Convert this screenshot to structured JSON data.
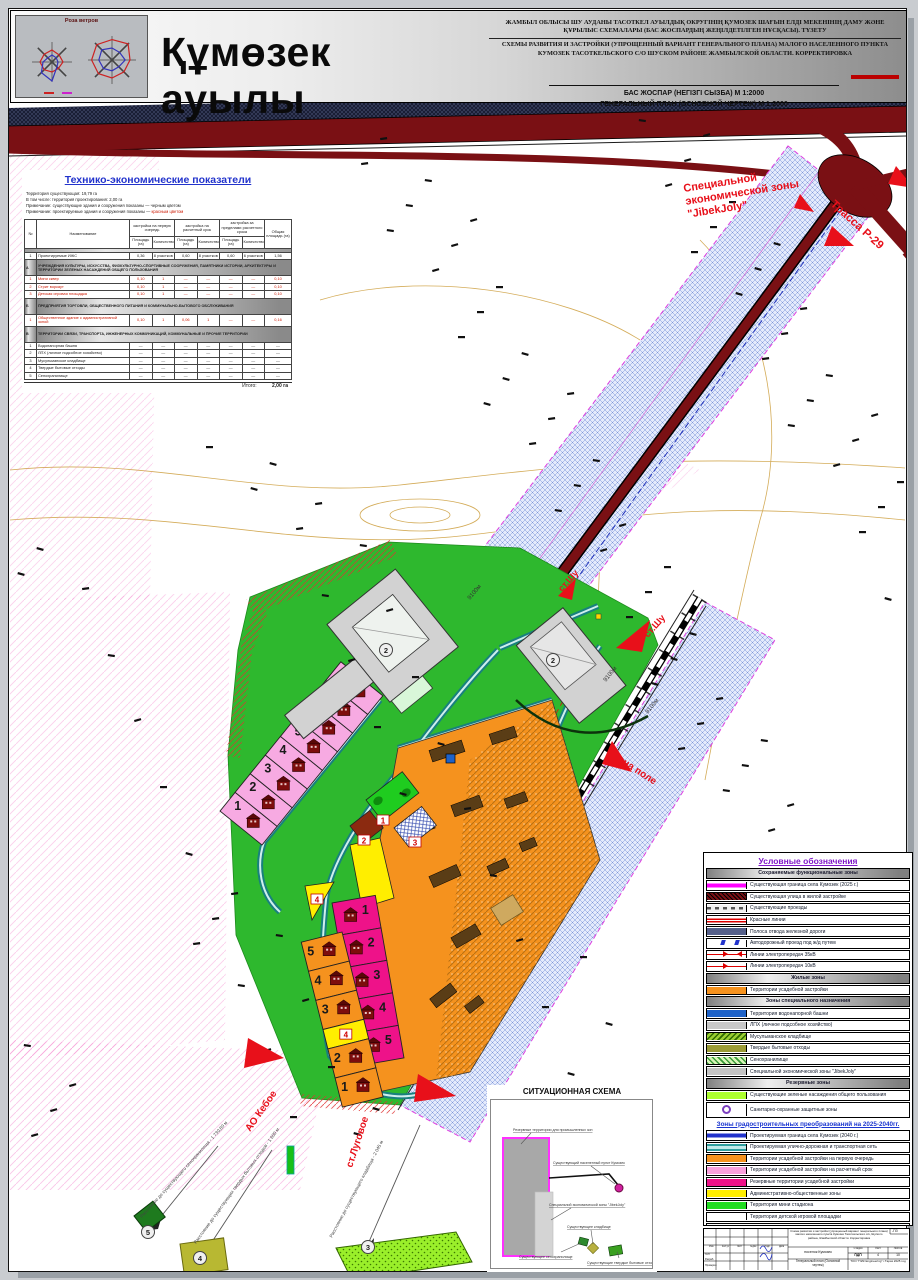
{
  "header": {
    "title": "Құмөзек ауылы",
    "windrose_title": "Роза ветров",
    "subtitle_kk": "ЖАМБЫЛ ОБЛЫСЫ ШУ АУДАНЫ ТАСОТКЕЛ АУЫЛДЫҚ ОКРУГІНІҢ ҚУМОЗЕК ШАҒЫН ЕЛДІ МЕКЕНІНІҢ ДАМУ ЖӘНЕ ҚҰРЫЛЫС СХЕМАЛАРЫ (БАС ЖОСПАРДЫҢ ЖЕҢІЛДЕТІЛГЕН НҰСҚАСЫ). ТҮЗЕТУ",
    "subtitle_ru": "СХЕМЫ РАЗВИТИЯ И ЗАСТРОЙКИ (УПРОЩЕННЫЙ ВАРИАНТ ГЕНЕРАЛЬНОГО ПЛАНА) МАЛОГО НАСЕЛЕННОГО ПУНКТА КУМОЗЕК ТАСОТКЕЛЬСКОГО С/О ШУСКОМ РАЙОНЕ ЖАМБЫЛСКОЙ ОБЛАСТИ. КОРРЕКТИРОВКА",
    "scale_kk": "БАС ЖОСПАР (НЕГІЗГІ СЫЗБА) М 1:2000",
    "scale_ru": "ГЕНЕРАЛЬНЫЙ ПЛАН (ОСНОВНОЙ ЧЕРТЕЖ) М 1:2000"
  },
  "tep": {
    "title": "Технико-экономические показатели",
    "notes": [
      {
        "t": "Территория существующая: 19,79 га"
      },
      {
        "t": "В том числе: территория проектирования: 2,00 га"
      },
      {
        "t": "Примечание: существующие здания и сооружения показаны — черным цветом"
      },
      {
        "t": "Примечание: проектируемые здания и сооружения показаны — ",
        "red": "красным цветом"
      }
    ],
    "col_num": "№",
    "col_name": "Наименование",
    "groups": [
      "застройка на первую очередь",
      "застройка на расчетный срок",
      "застройка за пределами расчетного срока"
    ],
    "subcols": [
      "Площадь (га)",
      "Количество"
    ],
    "col_total": "Общая площадь (га)",
    "rows": [
      {
        "kind": "data",
        "num": "1",
        "name": "Проектируемые ИЖС",
        "c": [
          "0,36",
          "8 участков",
          "0,60",
          "8 участков",
          "0,60",
          "6 участков"
        ],
        "total": "1,56",
        "red": false
      },
      {
        "kind": "section",
        "num": "А",
        "name": "УЧРЕЖДЕНИЯ КУЛЬТУРЫ, ИСКУССТВА, ФИЗКУЛЬТУРНО-СПОРТИВНЫЕ СООРУЖЕНИЯ, ПАМЯТНИКИ ИСТОРИИ, АРХИТЕКТУРЫ И ТЕРРИТОРИИ ЗЕЛЕНЫХ НАСАЖДЕНИЙ ОБЩЕГО ПОЛЬЗОВАНИЯ"
      },
      {
        "kind": "data",
        "num": "1",
        "name": "Мини сквер",
        "c": [
          "0,10",
          "1",
          "—",
          "—",
          "—",
          "—"
        ],
        "total": "0,10",
        "red": true
      },
      {
        "kind": "data",
        "num": "2",
        "name": "Стрит воркаут",
        "c": [
          "0,10",
          "1",
          "—",
          "—",
          "—",
          "—"
        ],
        "total": "0,10",
        "red": true
      },
      {
        "kind": "data",
        "num": "3",
        "name": "Детская игровая площадка",
        "c": [
          "0,10",
          "1",
          "—",
          "—",
          "—",
          "—"
        ],
        "total": "0,10",
        "red": true
      },
      {
        "kind": "section",
        "num": "Б",
        "name": "ПРЕДПРИЯТИЯ ТОРГОВЛИ, ОБЩЕСТВЕННОГО ПИТАНИЯ И КОММУНАЛЬНО-БЫТОВОГО ОБСЛУЖИВАНИЯ"
      },
      {
        "kind": "data",
        "num": "1",
        "name": "Общественное здание с административной зоной",
        "c": [
          "0,10",
          "1",
          "0,06",
          "1",
          "—",
          "—"
        ],
        "total": "0,16",
        "red": true
      },
      {
        "kind": "section",
        "num": "В",
        "name": "ТЕРРИТОРИИ СВЯЗИ, ТРАНСПОРТА, ИНЖЕНЕРНЫХ КОММУНИКАЦИЙ, КОММУНАЛЬНЫЕ И ПРОЧИЕ ТЕРРИТОРИИ"
      },
      {
        "kind": "data",
        "num": "1",
        "name": "Водонапорная башня",
        "c": [
          "—",
          "—",
          "—",
          "—",
          "—",
          "—"
        ],
        "total": "—",
        "red": false
      },
      {
        "kind": "data",
        "num": "2",
        "name": "ЛПХ (личное подсобное хозяйство)",
        "c": [
          "—",
          "—",
          "—",
          "—",
          "—",
          "—"
        ],
        "total": "—",
        "red": false
      },
      {
        "kind": "data",
        "num": "3",
        "name": "Мусульманское кладбище",
        "c": [
          "—",
          "—",
          "—",
          "—",
          "—",
          "—"
        ],
        "total": "—",
        "red": false
      },
      {
        "kind": "data",
        "num": "4",
        "name": "Твердые бытовые отходы",
        "c": [
          "—",
          "—",
          "—",
          "—",
          "—",
          "—"
        ],
        "total": "—",
        "red": false
      },
      {
        "kind": "data",
        "num": "5",
        "name": "Сенохранилище",
        "c": [
          "—",
          "—",
          "—",
          "—",
          "—",
          "—"
        ],
        "total": "—",
        "red": false
      }
    ],
    "total_label": "Итого:",
    "total_value": "2,00 га"
  },
  "legend": {
    "title": "Условные обозначения",
    "sections": [
      {
        "header": "Сохраняемые функциональные зоны",
        "items": [
          {
            "swatch": "boundary2025",
            "label": "Существующая граница села Кумозек (2025 г.)"
          },
          {
            "swatch": "street",
            "label": "Существующая улица в жилой застройке"
          },
          {
            "swatch": "driveway",
            "label": "Существующие проезды"
          },
          {
            "swatch": "redlines",
            "label": "Красные линии"
          },
          {
            "swatch": "railband",
            "label": "Полоса отвода железной дороги"
          },
          {
            "swatch": "underpass",
            "label": "Автодорожный проезд под ж/д путем"
          },
          {
            "swatch": "lep35",
            "label": "Линии электропередач 35кВ"
          },
          {
            "swatch": "lep10",
            "label": "Линии электропередач 10кВ"
          }
        ]
      },
      {
        "header": "Жилые зоны",
        "items": [
          {
            "swatch": "usadeb",
            "label": "Территории усадебной застройки"
          }
        ]
      },
      {
        "header": "Зоны специального назначения",
        "items": [
          {
            "swatch": "watertower",
            "label": "Территория водонапорной башни"
          },
          {
            "swatch": "lph",
            "label": "ЛПХ (личное подсобное хозяйство)"
          },
          {
            "swatch": "cemetery",
            "label": "Мусульманское кладбище"
          },
          {
            "swatch": "tbo",
            "label": "Твердые бытовые отходы"
          },
          {
            "swatch": "hay",
            "label": "Сенохранилище"
          },
          {
            "swatch": "sez",
            "label": "Специальной экономической зоны \"JibekJoly\""
          }
        ]
      },
      {
        "header": "Резервные зоны",
        "items": [
          {
            "swatch": "greenery",
            "label": "Существующие зеленые насаждения общего пользования"
          },
          {
            "swatch": "sanitary",
            "label": "Санитарно-охранные защитные зоны",
            "tall": true
          }
        ]
      }
    ],
    "zones2040": {
      "title": "Зоны градостроительных преобразований на 2025-2040гг.",
      "items": [
        {
          "swatch": "boundary2040",
          "label": "Проектируемая граница села Кумозек (2040 г.)"
        },
        {
          "swatch": "roadnet",
          "label": "Проектируемая улично-дорожная и транспортная сеть"
        },
        {
          "swatch": "orange1",
          "label": "Территории усадебной застройки на первую очередь"
        },
        {
          "swatch": "pink2",
          "label": "Территории усадебной застройки на расчетный срок"
        },
        {
          "swatch": "magenta3",
          "label": "Резервные территории усадебной застройки"
        },
        {
          "swatch": "admin",
          "label": "Административно-общественные зоны"
        },
        {
          "swatch": "stadium",
          "label": "Территория мини стадиона"
        },
        {
          "swatch": "playground",
          "label": "Территория детской игровой площадки"
        },
        {
          "swatch": "workout",
          "label": "Территория стрит воркаута"
        },
        {
          "swatch": "shrp",
          "label": "Проектируемые шкафные регуляторные пункты"
        },
        {
          "swatch": "tp",
          "label": "Проектируемые трансформаторные  подстанции"
        }
      ]
    }
  },
  "map_labels": {
    "sez1": "Специальной",
    "sez2": "экономической зоны",
    "sez3": "\"JibekJoly\"",
    "trassa": "Трасса Р-29",
    "st_shu": "ст.Шу",
    "na_pole": "на поле",
    "st_lugovoe": "ст.Луговое",
    "ao_keboe": "АО Кебое",
    "dist_9100": "9100м"
  },
  "markers": {
    "circled": [
      "2",
      "2",
      "5",
      "4",
      "3"
    ],
    "boxed": [
      "1",
      "2",
      "3",
      "4",
      "4"
    ]
  },
  "parcels": {
    "pink": [
      "1",
      "2",
      "3",
      "4",
      "5",
      "6",
      "7",
      "8"
    ],
    "magenta": [
      "1",
      "2",
      "3",
      "4",
      "5"
    ],
    "orange": [
      "5",
      "4",
      "3",
      "2",
      "1"
    ]
  },
  "distances": [
    "Расстояние до существующего сенохранилища - 1 730,80 м",
    "Расстояние до существующих твердых бытовых отходов - 1 600 м",
    "Расстояние до существующего кладбища - 2 045 м"
  ],
  "sitmap": {
    "title": "СИТУАЦИОННАЯ СХЕМА",
    "labels": {
      "reserve": "Резервные территории для промышленных зон",
      "settlement": "Существующий населенный пункт Кумозек",
      "sez": "Специальной экономической зоны \"JibekJoly\"",
      "cemetery": "Существующее кладбище",
      "hay": "Существующее сенохранилище",
      "tbo": "Существующие твердые бытовые отходы"
    }
  },
  "stamp": {
    "code": "-ПЗ",
    "object": "Схема развития и застройки (упрощенный вариант генерального плана) малого населенного пункта Кумозек Тасоткельского с/о, Шуского района, Жамбылской области. Корректировка",
    "place": "поселок Кумозек",
    "stage_label": "Стадия",
    "sheet_label": "Лист",
    "sheets_label": "Листов",
    "stage": "ПДП",
    "sheet": "4",
    "sheets": "10",
    "doc": "Генеральный план (Основной чертеж)",
    "firm": "ТОО \"ПИК Engineering\" г.Тараз 2025 год",
    "head_cells": [
      "Изм.",
      "Кол.уч",
      "Лист",
      "№док.",
      "Подп.",
      "Дата"
    ],
    "sig_rows": [
      "ГАП",
      "Разраб.",
      "Проверил"
    ]
  },
  "windrose": {
    "charts": [
      {
        "red": [
          0.6,
          0.5,
          0.55,
          0.45,
          0.5,
          0.55,
          0.6,
          0.55
        ],
        "blue": [
          0.35,
          0.3,
          0.3,
          0.35,
          0.95,
          0.75,
          0.45,
          0.3
        ]
      },
      {
        "red": [
          0.85,
          0.95,
          0.75,
          0.7,
          0.75,
          0.8,
          0.85,
          0.9
        ],
        "blue": [
          0.5,
          0.45,
          0.55,
          0.4,
          0.45,
          0.5,
          0.55,
          0.6
        ]
      }
    ]
  },
  "colors": {
    "road_dark_red": "#7a1014",
    "sez_band_blue": "#dfe7fa",
    "boundary_magenta": "#ff00ff",
    "village_green": "#2eb82e",
    "usadeb_orange": "#F5921E",
    "pink_plots": "#f7aae2",
    "magenta_plots": "#EE1289",
    "admin_yellow": "#FFEE00",
    "road_teal": "#18807e",
    "label_red": "#e8101a"
  }
}
